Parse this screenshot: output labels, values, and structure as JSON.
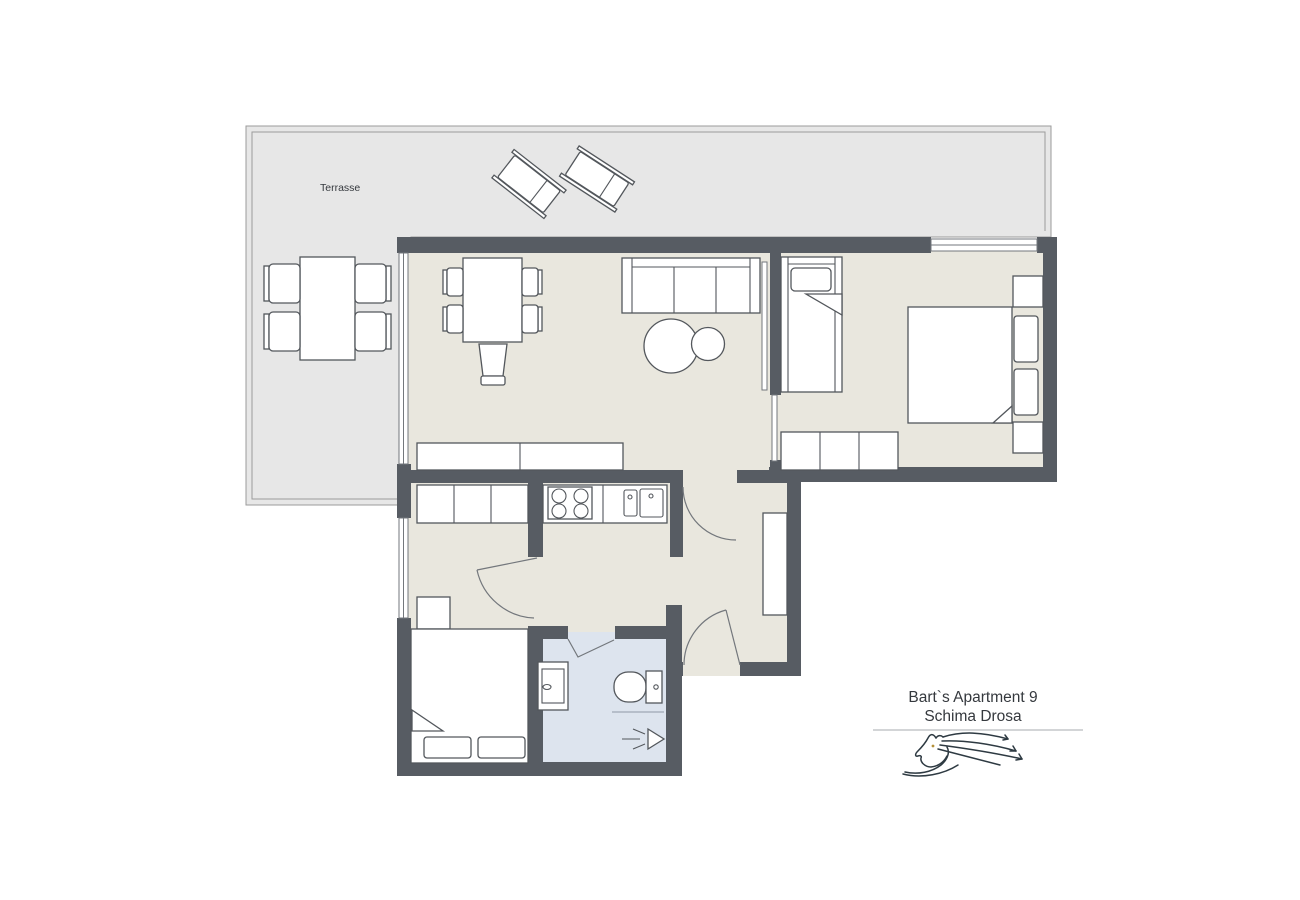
{
  "colors": {
    "wall": "#575c63",
    "floor": "#e9e7de",
    "terrace": "#e7e7e7",
    "bathroom_floor": "#dde4ee",
    "line": "#53575c",
    "light_line": "#9b9b9b",
    "door": "#73777c",
    "logo": "#2e3a42",
    "eye": "#b5913a",
    "text": "#35393e",
    "rule": "#8a8f94"
  },
  "terrace": {
    "label": "Terrasse"
  },
  "footer": {
    "line1": "Bart`s Apartment 9",
    "line2": "Schima Drosa",
    "logo_icon": "horse-logo"
  }
}
